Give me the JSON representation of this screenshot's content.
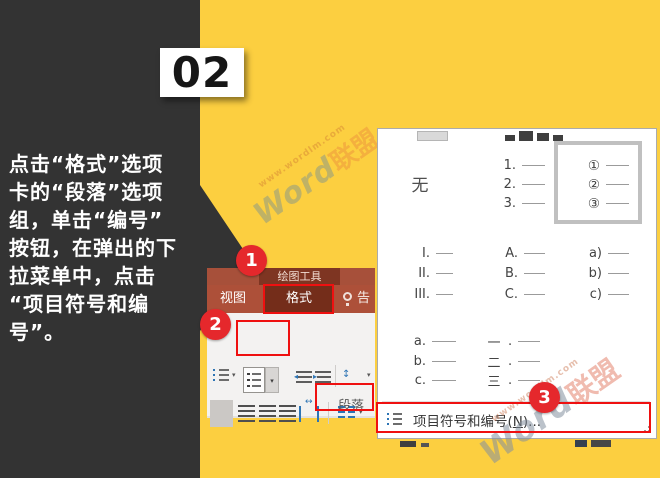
{
  "colors": {
    "background_yellow": "#fccf40",
    "panel_dark": "#333333",
    "annotation_red": "#ef1010",
    "callout_red": "#e5282c",
    "ribbon_context_bg": "#a7503a",
    "ribbon_context_box": "#7e3522",
    "ribbon_tabrow_bg": "#ad5039",
    "ribbon_active_tab_bg": "#742d1a",
    "ribbon_body_bg": "#f3f2f1",
    "menu_bg": "#ffffff",
    "selection_border_gray": "#c0c0c0",
    "icon_blue": "#2e75b5"
  },
  "step_badge": {
    "number": "02"
  },
  "instruction": {
    "text": "点击“格式”选项\n卡的“段落”选项\n组，单击“编号”\n按钮，在弹出的下\n拉菜单中，点击\n“项目符号和编\n号”。"
  },
  "watermark": {
    "url": "www.wordlm.com",
    "brand_latin": "Word",
    "brand_cjk": "联盟"
  },
  "callouts": {
    "c1": "1",
    "c2": "2",
    "c3": "3"
  },
  "ribbon": {
    "context_header": "绘图工具",
    "tab_view": "视图",
    "tab_format": "格式",
    "tellme_label": "告",
    "group_label": "段落"
  },
  "menu": {
    "gallery": {
      "none_label": "无",
      "decimal": [
        "1.",
        "2.",
        "3."
      ],
      "circled": [
        "①",
        "②",
        "③"
      ],
      "roman": [
        "I.",
        "II.",
        "III."
      ],
      "upper_alpha": [
        "A.",
        "B.",
        "C."
      ],
      "lower_alpha_paren": [
        "a)",
        "b)",
        "c)"
      ],
      "lower_alpha": [
        "a.",
        "b.",
        "c."
      ],
      "cjk": [
        "一",
        "二",
        "三"
      ],
      "cjk_dot": "."
    },
    "bullets_item": {
      "pre": "项目符号和编号(",
      "accel": "N",
      "post": ")..."
    }
  }
}
